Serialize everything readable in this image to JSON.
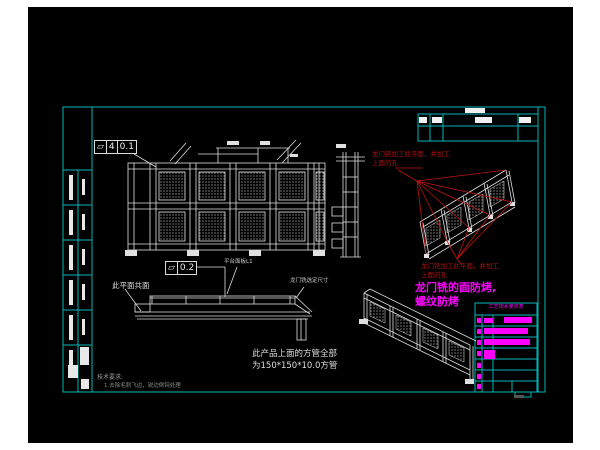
{
  "colors": {
    "canvas": "#000000",
    "page_margin": "#ffffff",
    "sheet_line": "#00b7b7",
    "drawing_line": "#e0e0e0",
    "red_annotation": "#b41414",
    "magenta_annotation": "#ff00ff"
  },
  "tolerance_frames": {
    "frame1": {
      "symbol": "▱",
      "zone": "4",
      "value": "0.1"
    },
    "frame2": {
      "symbol": "▱",
      "value": "0.2"
    }
  },
  "labels": {
    "coplanar": "此平面共面",
    "platform": "平台面板L1",
    "gantry_dim": "龙门铣选定尺寸"
  },
  "red_notes": {
    "upper_line1": "龙门铣加工此平面，并加工",
    "upper_line2": "上面的孔",
    "lower_line1": "龙门铣加工此平面，并加工",
    "lower_line2": "上面的孔"
  },
  "magenta_note": {
    "line1": "龙门铣的面防烤,",
    "line2": "螺纹防烤"
  },
  "notes": {
    "tech_title": "技术要求:",
    "tech_item": "1.去除毛刺飞边，锐边倒钝处理",
    "tube_line1": "此产品上面的方管全部",
    "tube_line2": "为150*150*10.0方管"
  },
  "title_block": {
    "header": "工艺技术要求表"
  }
}
